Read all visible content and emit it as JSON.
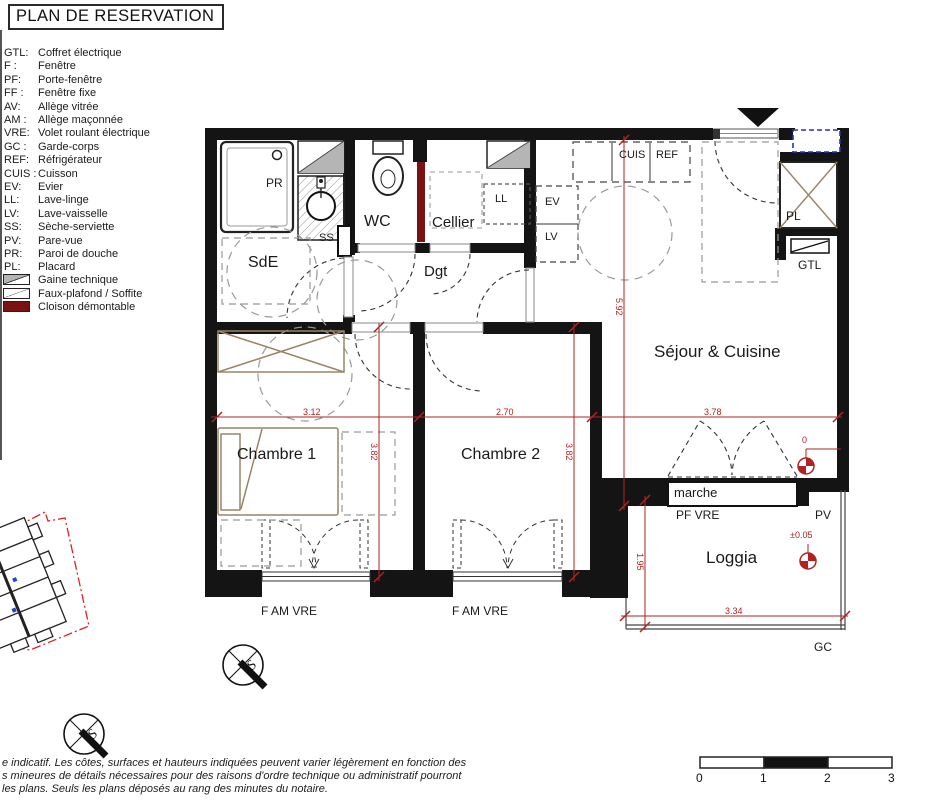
{
  "title": "PLAN DE RESERVATION",
  "legend": {
    "items": [
      {
        "abbr": "GTL:",
        "label": "Coffret électrique"
      },
      {
        "abbr": "F :",
        "label": "Fenêtre"
      },
      {
        "abbr": "PF:",
        "label": "Porte-fenêtre"
      },
      {
        "abbr": "FF :",
        "label": "Fenêtre fixe"
      },
      {
        "abbr": "AV:",
        "label": "Allège vitrée"
      },
      {
        "abbr": "AM :",
        "label": "Allège maçonnée"
      },
      {
        "abbr": "VRE:",
        "label": "Volet roulant électrique"
      },
      {
        "abbr": "GC :",
        "label": "Garde-corps"
      },
      {
        "abbr": "REF:",
        "label": "Réfrigérateur"
      },
      {
        "abbr": "CUIS :",
        "label": "Cuisson"
      },
      {
        "abbr": "EV:",
        "label": "Evier"
      },
      {
        "abbr": "LL:",
        "label": "Lave-linge"
      },
      {
        "abbr": "LV:",
        "label": "Lave-vaisselle"
      },
      {
        "abbr": "SS:",
        "label": "Sèche-serviette"
      },
      {
        "abbr": "PV:",
        "label": "Pare-vue"
      },
      {
        "abbr": "PR:",
        "label": "Paroi de douche"
      },
      {
        "abbr": "PL:",
        "label": "Placard"
      }
    ],
    "swatches": [
      {
        "icon": "gaine-swatch",
        "label": "Gaine technique"
      },
      {
        "icon": "soffite-swatch",
        "label": "Faux-plafond / Soffite"
      },
      {
        "icon": "cloison-swatch",
        "label": "Cloison démontable"
      }
    ]
  },
  "plan": {
    "rooms": {
      "sde": "SdE",
      "wc": "WC",
      "cellier": "Cellier",
      "dgt": "Dgt",
      "sejour": "Séjour & Cuisine",
      "chambre1": "Chambre 1",
      "chambre2": "Chambre 2",
      "loggia": "Loggia"
    },
    "fixtures": {
      "pr": "PR",
      "ss": "SS",
      "ll": "LL",
      "ev": "EV",
      "lv": "LV",
      "cuis": "CUIS",
      "ref": "REF",
      "pl": "PL",
      "gtl": "GTL"
    },
    "openings": {
      "marche": "marche",
      "pf_vre": "PF VRE",
      "pv": "PV",
      "gc": "GC",
      "f_am_vre_1": "F AM VRE",
      "f_am_vre_2": "F AM VRE"
    }
  },
  "dimensions": {
    "chambre1_width": "3.12",
    "chambre2_width": "2.70",
    "sejour_width": "3.78",
    "chambre1_depth": "3.82",
    "chambre2_depth": "3.82",
    "sejour_depth": "5.92",
    "loggia_depth": "1.95",
    "loggia_width": "3.34"
  },
  "levels": {
    "sejour": "0",
    "loggia": "±0.05"
  },
  "scale_bar": {
    "labels": [
      "0",
      "1",
      "2",
      "3"
    ]
  },
  "compass": {
    "letter": "S"
  },
  "disclaimer": {
    "line1": "e indicatif. Les côtes, surfaces et hauteurs indiquées peuvent varier légèrement en fonction des",
    "line2": "s mineures de détails nécessaires pour des raisons d'ordre technique ou administratif pourront",
    "line3": "les plans. Seuls les plans déposés au rang des minutes du notaire."
  },
  "colors": {
    "wall": "#141414",
    "dimension_red": "#b22222",
    "cloison_demontable": "#7a1212",
    "furniture_tan": "#9a8468",
    "accent_blue": "#2233bb",
    "site_boundary_red": "#e02020",
    "gaine_gray": "#b5b5b5"
  }
}
